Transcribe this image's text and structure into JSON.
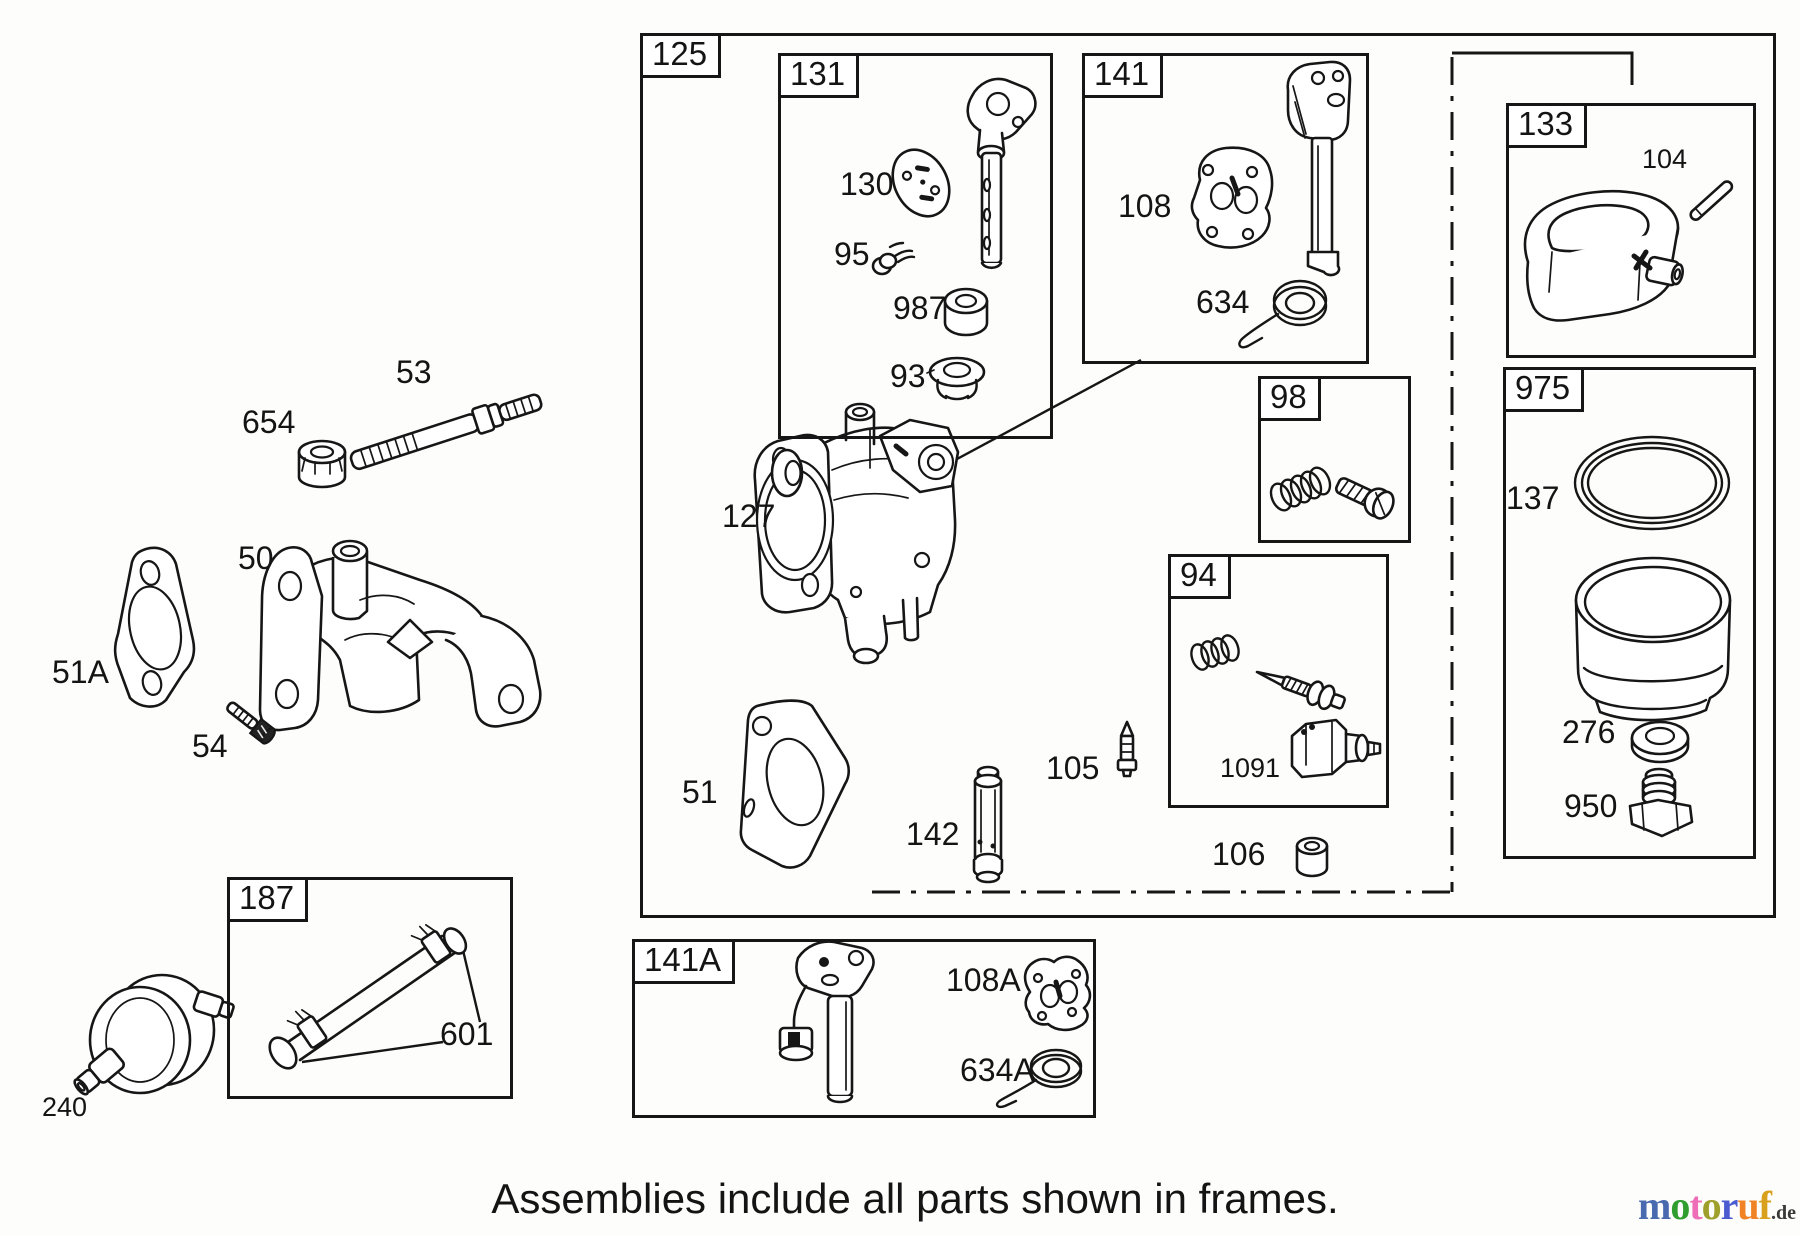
{
  "page": {
    "footer_text": "Assemblies include all parts shown in frames."
  },
  "frames": {
    "f125": "125",
    "f131": "131",
    "f141": "141",
    "f133": "133",
    "f98": "98",
    "f975": "975",
    "f94": "94",
    "f187": "187",
    "f141a": "141A"
  },
  "labels": {
    "p53": "53",
    "p654": "654",
    "p50": "50",
    "p51a": "51A",
    "p54": "54",
    "p240": "240",
    "p130": "130",
    "p95": "95",
    "p987": "987",
    "p93": "93",
    "p127": "127",
    "p51": "51",
    "p142": "142",
    "p105": "105",
    "p106": "106",
    "p108": "108",
    "p634": "634",
    "p104": "104",
    "p137": "137",
    "p276": "276",
    "p950": "950",
    "p1091": "1091",
    "p601": "601",
    "p108a": "108A",
    "p634a": "634A"
  },
  "logo": {
    "letters": [
      {
        "ch": "m",
        "color": "#4a6ab0"
      },
      {
        "ch": "o",
        "color": "#2f9e2f"
      },
      {
        "ch": "t",
        "color": "#ef6eb8"
      },
      {
        "ch": "o",
        "color": "#9fa02c"
      },
      {
        "ch": "r",
        "color": "#4a5cd0"
      },
      {
        "ch": "u",
        "color": "#f08326"
      },
      {
        "ch": "f",
        "color": "#d8a01c"
      }
    ],
    "tld": ".de",
    "tld_color": "#3a3a3a"
  }
}
